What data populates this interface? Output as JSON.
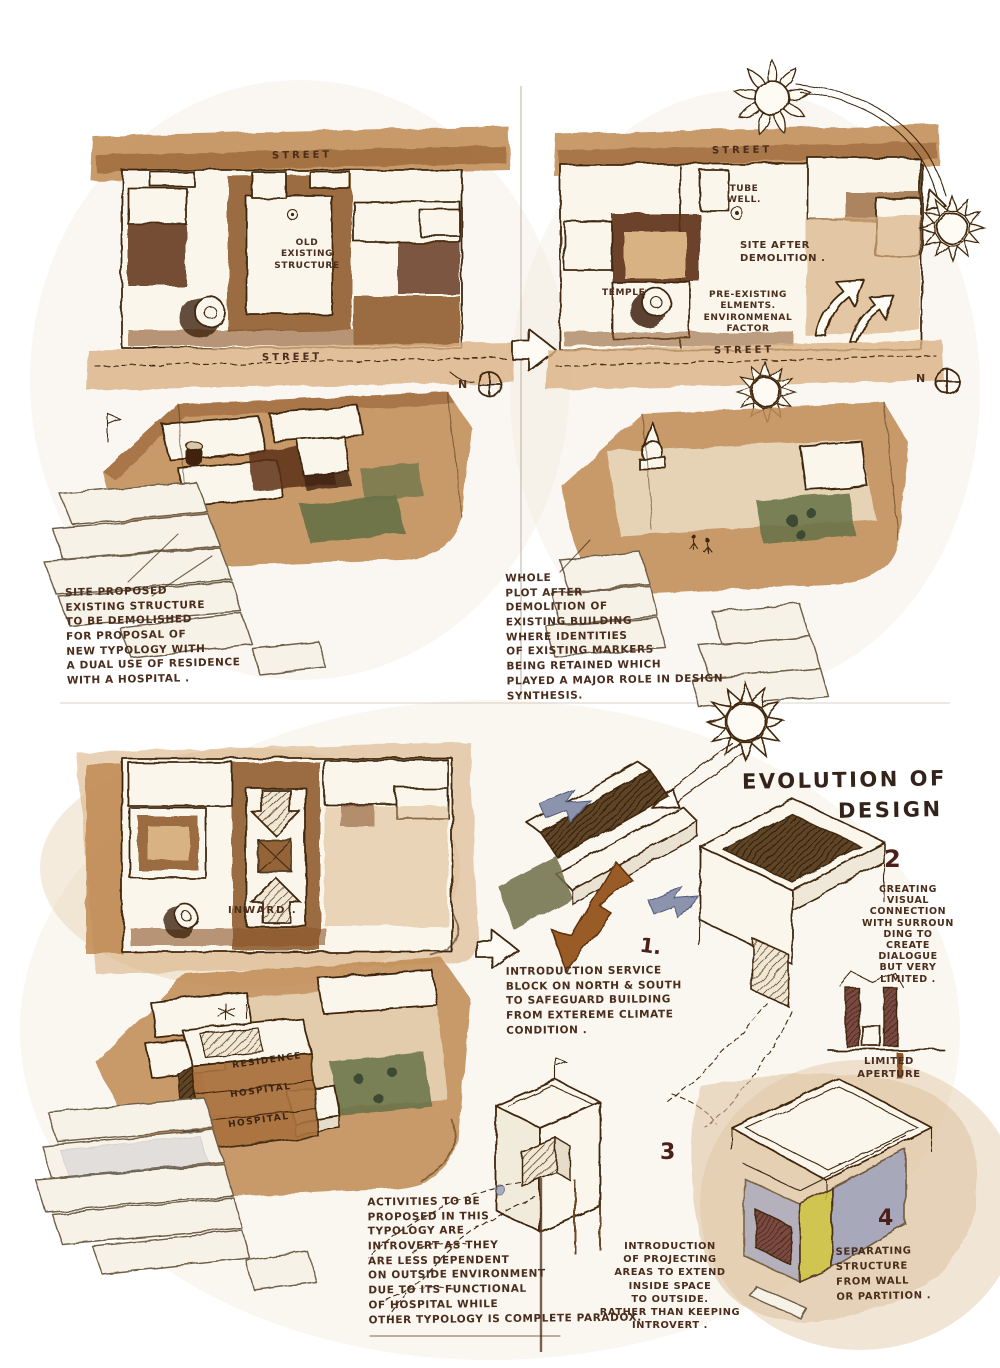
{
  "colors": {
    "ink": "#40280e",
    "text": "#4a2d1c",
    "number": "#4a2018",
    "wash_tan": "#c08a52",
    "wash_sienna": "#8a5426",
    "wash_umber": "#5c3014",
    "wash_green": "#667247",
    "wash_olive": "#6f6f49",
    "arrow_blue": "#8b93ad",
    "arrow_brown": "#9a5c25",
    "wash_yellow": "#cdc23f",
    "wash_violet": "#8e97bd"
  },
  "icons": {
    "sun": "sun-icon",
    "north_compass": "crossed-circle",
    "transition_arrow": "hollow-right-arrow",
    "inward_arrow": "hatched-arrow",
    "wind_arrow": "blue-arrow",
    "climate_arrow": "brown-arrow"
  },
  "top_left": {
    "street_top": "STREET",
    "plan_label": "OLD EXISTING\nSTRUCTURE",
    "street_bottom": "STREET",
    "north_label": "N",
    "caption": "SITE PROPOSED\nEXISTING STRUCTURE\nTO BE DEMOLISHED\nFOR PROPOSAL OF\nNEW TYPOLOGY WITH\nA DUAL USE OF RESIDENCE\nWITH A HOSPITAL ."
  },
  "top_right": {
    "street_top": "STREET",
    "tube_well": "TUBE\nWELL.",
    "site_after": "SITE AFTER\nDEMOLITION .",
    "temple": "TEMPLE",
    "pre_existing": "PRE-EXISTING\nELMENTS.\nENVIRONMENAL\nFACTOR",
    "street_bottom": "STREET",
    "north_label": "N",
    "caption": "WHOLE\nPLOT AFTER\nDEMOLITION OF\nEXISTING BUILDING\nWHERE IDENTITIES\nOF EXISTING MARKERS\nBEING RETAINED WHICH\nPLAYED A MAJOR ROLE IN DESIGN\nSYNTHESIS."
  },
  "evolution": {
    "title_line1": "EVOLUTION OF",
    "title_line2": "DESIGN",
    "inward_label": "INWARD .",
    "step1_num": "1.",
    "step1_caption": "INTRODUCTION SERVICE\nBLOCK ON NORTH & SOUTH\nTO SAFEGUARD BUILDING\nFROM EXTEREME CLIMATE\nCONDITION .",
    "step2_num": "2",
    "step2_caption": "CREATING\nVISUAL\nCONNECTION\nWITH SURROUN\nDING TO\nCREATE\nDIALOGUE\nBUT VERY\nLIMITED .",
    "step2_sub": "LIMITED\nAPERTURE",
    "step3_num": "3",
    "step3_caption": "INTRODUCTION\nOF PROJECTING\nAREAS TO EXTEND\nINSIDE SPACE\nTO OUTSIDE.\nRATHER THAN KEEPING\nINTROVERT .",
    "step4_num": "4",
    "step4_caption": "SEPARATING\nSTRUCTURE\nFROM WALL\nOR PARTITION .",
    "tower_labels": [
      "RESIDENCE",
      "HOSPITAL",
      "HOSPITAL"
    ],
    "typology_caption": "ACTIVITIES TO BE\nPROPOSED IN THIS\nTYPOLOGY ARE\nINTROVERT AS THEY\nARE LESS DEPENDENT\nON OUTSIDE ENVIRONMENT\nDUE TO ITS FUNCTIONAL\nOF HOSPITAL WHILE\nOTHER TYPOLOGY IS COMPLETE PARADOX."
  }
}
